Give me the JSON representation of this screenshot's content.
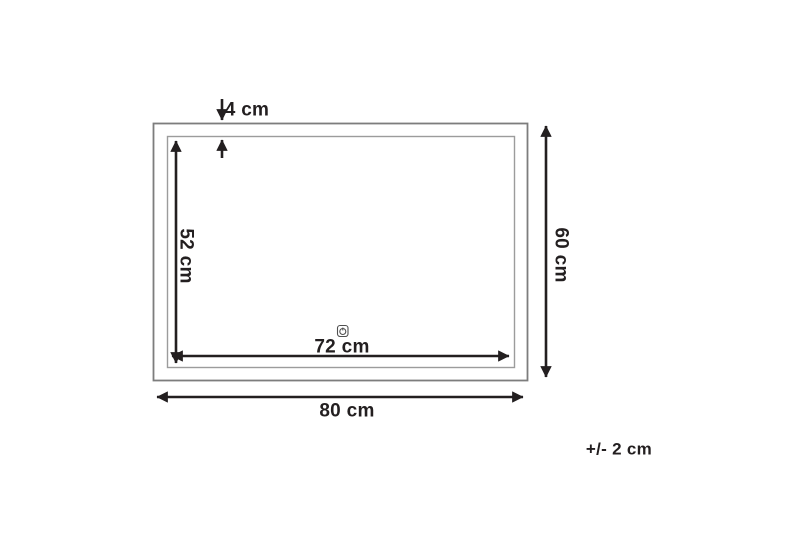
{
  "diagram": {
    "name": "mirror-dimension-diagram",
    "labels": {
      "frame_border": "4 cm",
      "inner_height": "52 cm",
      "inner_width": "72 cm",
      "outer_height": "60 cm",
      "outer_width": "80 cm",
      "tolerance": "+/- 2 cm"
    },
    "measurements": {
      "outer_width_cm": 80,
      "outer_height_cm": 60,
      "inner_width_cm": 72,
      "inner_height_cm": 52,
      "frame_border_cm": 4,
      "tolerance_cm": 2
    },
    "icons": {
      "touch_sensor": "touch-sensor-icon"
    },
    "colors": {
      "dimension": "#231f20",
      "frame_outer": "#7d7d7d",
      "frame_inner": "#9c9c9c",
      "background": "#ffffff"
    }
  }
}
